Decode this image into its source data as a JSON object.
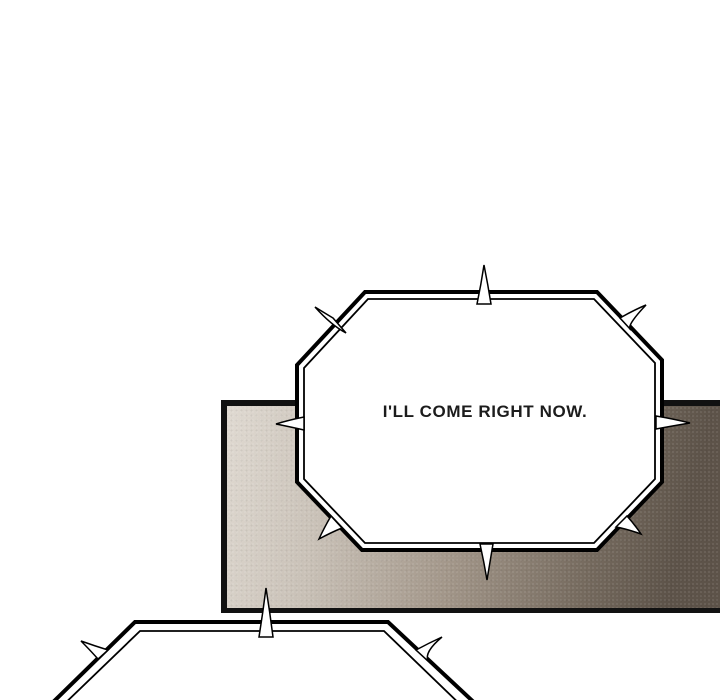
{
  "scene": {
    "type": "webtoon-comic-panel",
    "background_color": "#ffffff"
  },
  "panel": {
    "border_color": "#111111",
    "gradient": [
      "#e0dad2",
      "#c9c1b7",
      "#a3978a",
      "#756a5e",
      "#5d5349"
    ]
  },
  "speech_bubbles": {
    "main": {
      "style": "spiked-octagon",
      "fill": "#ffffff",
      "outline": "#000000",
      "text": "I'LL COME RIGHT NOW."
    },
    "partial": {
      "style": "spiked-octagon",
      "fill": "#ffffff",
      "outline": "#000000",
      "text": ""
    }
  }
}
